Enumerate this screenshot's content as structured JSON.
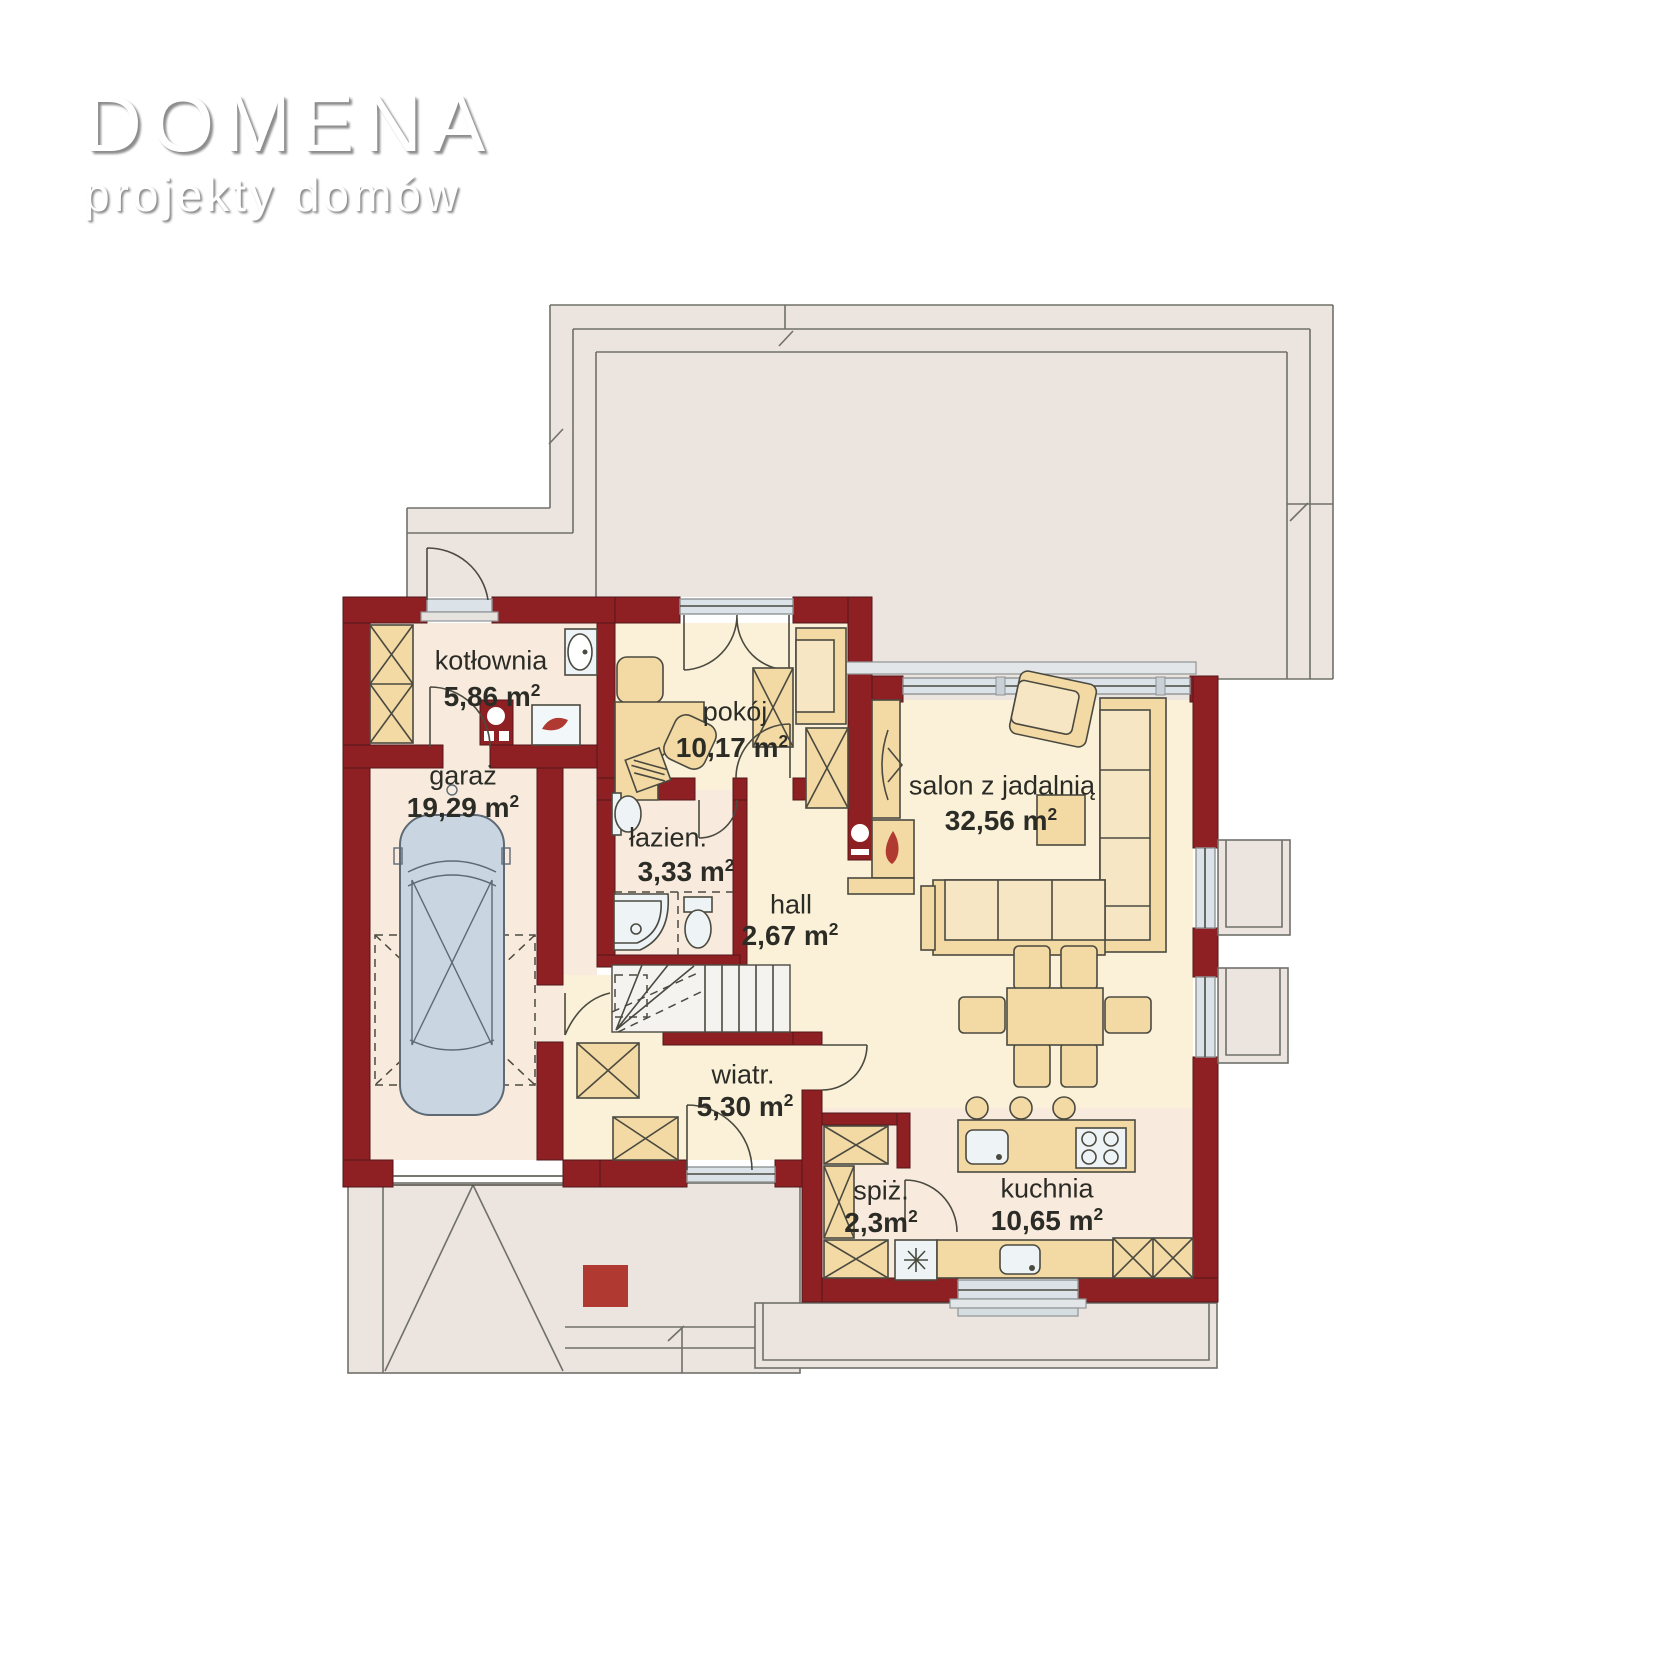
{
  "brand": {
    "title": "DOMENA",
    "subtitle": "projekty domów"
  },
  "plan": {
    "type": "floor-plan",
    "rooms": [
      {
        "id": "kotlownia",
        "name": "kotłownia",
        "area": "5,86 m",
        "sup": "2"
      },
      {
        "id": "garaz",
        "name": "garaż",
        "area": "19,29 m",
        "sup": "2"
      },
      {
        "id": "pokoj",
        "name": "pokój",
        "area": "10,17 m",
        "sup": "2"
      },
      {
        "id": "lazienka",
        "name": "łazien.",
        "area": "3,33 m",
        "sup": "2"
      },
      {
        "id": "hall",
        "name": "hall",
        "area": "2,67 m",
        "sup": "2"
      },
      {
        "id": "salon",
        "name": "salon z jadalnią",
        "area": "32,56 m",
        "sup": "2"
      },
      {
        "id": "wiatrolap",
        "name": "wiatr.",
        "area": "5,30 m",
        "sup": "2"
      },
      {
        "id": "spizarnia",
        "name": "spiż.",
        "area": "2,3m",
        "sup": "2"
      },
      {
        "id": "kuchnia",
        "name": "kuchnia",
        "area": "10,65 m",
        "sup": "2"
      }
    ]
  },
  "colors": {
    "wall": "#8e2023",
    "cream": "#faf1d8",
    "pink": "#f8ebdd",
    "terrace": "#ece4de",
    "furn": "#f3d9a4",
    "furnlight": "#f7e6c4",
    "glass": "#dce3e8",
    "fixture": "#eef3f6",
    "car": "#c9d6e2",
    "stairs": "#f4f3f0",
    "accent": "#b03931"
  }
}
